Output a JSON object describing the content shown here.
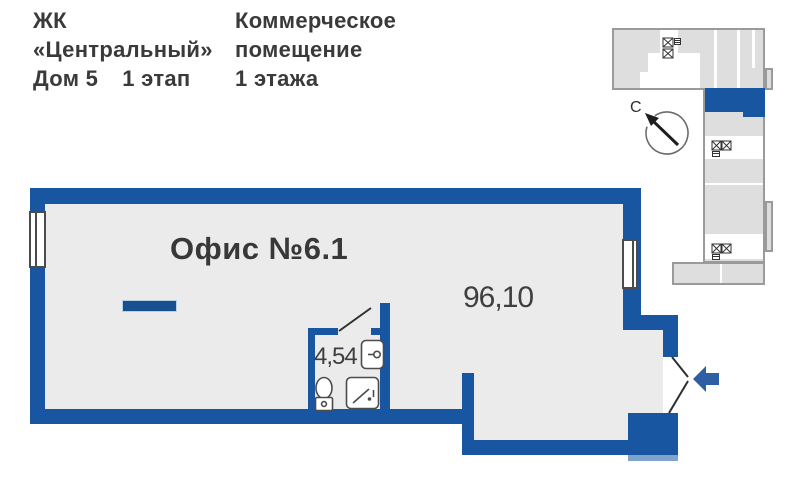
{
  "header": {
    "complex_line1": "ЖК",
    "complex_line2": "«Центральный»",
    "house": "Дом 5",
    "stage": "1 этап",
    "type_line1": "Коммерческое",
    "type_line2": "помещение",
    "type_line3": "1 этажа"
  },
  "plan": {
    "unit_label": "Офис №6.1",
    "main_area": "96,10",
    "bathroom_area": "4,54"
  },
  "compass": {
    "north_label": "С"
  },
  "icons": {
    "entrance_arrow_icon": "left-pointing solid arrow",
    "north_arrow_icon": "up-left arrow in open circle",
    "toilet_icon": "toilet outline",
    "sink_icon": "washbasin outline",
    "shower_icon": "shower tray outline",
    "elevator_icon": "square with X",
    "stairs_icon": "hatched block",
    "window_icon": "double-line window bar"
  },
  "colors": {
    "wall_blue": "#1856a2",
    "floor_gray": "#ebebeb",
    "entrance_arrow_blue": "#2e5fa4",
    "map_fill_gray": "#dedede",
    "map_border_gray": "#9a9a9a",
    "unit_highlight_blue": "#1856a2",
    "text_dark": "#3a3a3a"
  }
}
